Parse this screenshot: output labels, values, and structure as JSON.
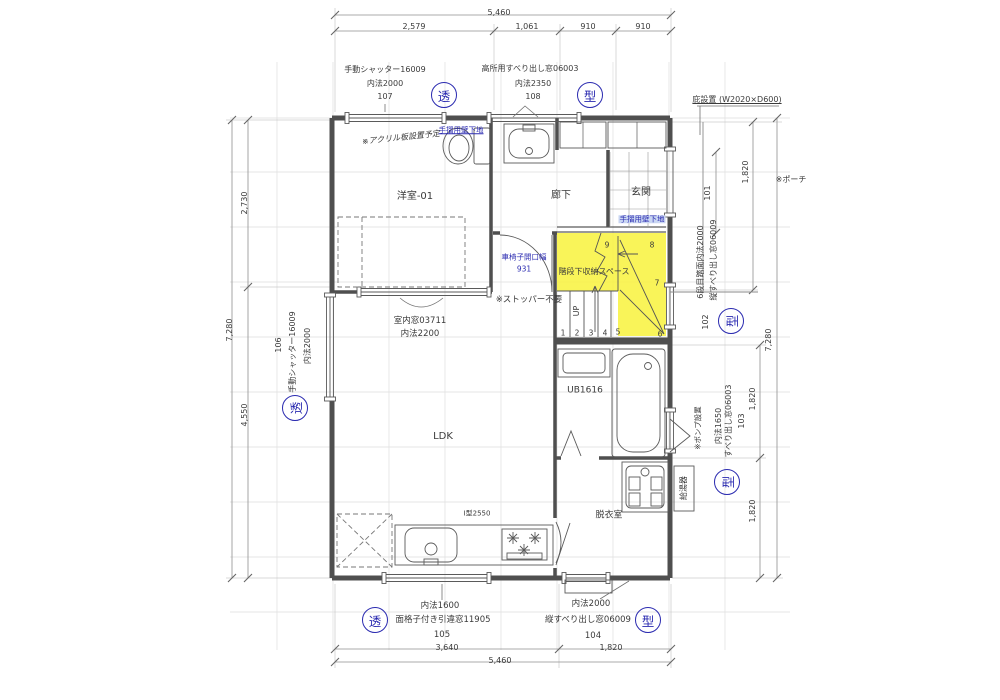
{
  "colors": {
    "accent_blue": "#2a2ab0",
    "highlight_yellow": "#f8f23c",
    "wall_line": "#4f4f4f",
    "dim_line": "#909090"
  },
  "dimensions": {
    "top_total": "5,460",
    "top_segments": [
      "2,579",
      "1,061",
      "910",
      "910"
    ],
    "bottom_total": "5,460",
    "bottom_segments": [
      "3,640",
      "1,820"
    ],
    "left_total": "7,280",
    "left_segments": [
      "2,730",
      "4,550"
    ],
    "right_total": "7,280",
    "right_porch": "1,820",
    "right_bath": "1,820",
    "right_bottom": "1,820"
  },
  "windows": {
    "top_left": {
      "name": "手動シャッター16009",
      "size": "内法2000",
      "no": "107",
      "glass": "透"
    },
    "top_right": {
      "name": "高所用すべり出し窓06003",
      "size": "内法2350",
      "no": "108",
      "glass": "型"
    },
    "left": {
      "name": "手動シャッター16009",
      "size": "内法2000",
      "no": "106",
      "glass": "透"
    },
    "interior": {
      "name": "室内窓03711",
      "size": "内法2200"
    },
    "stairs": {
      "note": "6段目踏面内法2000",
      "name": "縦すべり出し窓06009",
      "no": "102",
      "glass": "型"
    },
    "bath": {
      "size": "内法1650",
      "name": "すべり出し窓06003",
      "no": "103",
      "glass": "型"
    },
    "kitchen": {
      "size": "内法1600",
      "name": "面格子付き引違窓11905",
      "no": "105",
      "glass": "透"
    },
    "dressing": {
      "size": "内法2000",
      "name": "縦すべり出し窓06009",
      "no": "104",
      "glass": "型"
    },
    "entrance_no": "101"
  },
  "rooms": {
    "bedroom": "洋室-01",
    "hallway": "廊下",
    "entrance": "玄関",
    "ldk": "LDK",
    "bath": "UB1616",
    "dressing": "脱衣室",
    "kitchen_type": "I型2550"
  },
  "notes": {
    "acrylic": "※アクリル板設置予定",
    "handrail_wall": "手摺用壁下地",
    "handrail_wall2": "手摺用壁下地",
    "wheelchair": "車椅子開口幅",
    "wheelchair_width": "931",
    "stopper": "※ストッパー不要",
    "storage": "階段下収納スペース",
    "pump": "※ポンプ設置",
    "water_heater": "給湯器",
    "porch": "※ポーチ",
    "canopy": "庇設置 (W2020×D600)",
    "up": "UP"
  },
  "stairs": {
    "steps": [
      "1",
      "2",
      "3",
      "4",
      "5",
      "6",
      "7",
      "8",
      "9"
    ]
  }
}
